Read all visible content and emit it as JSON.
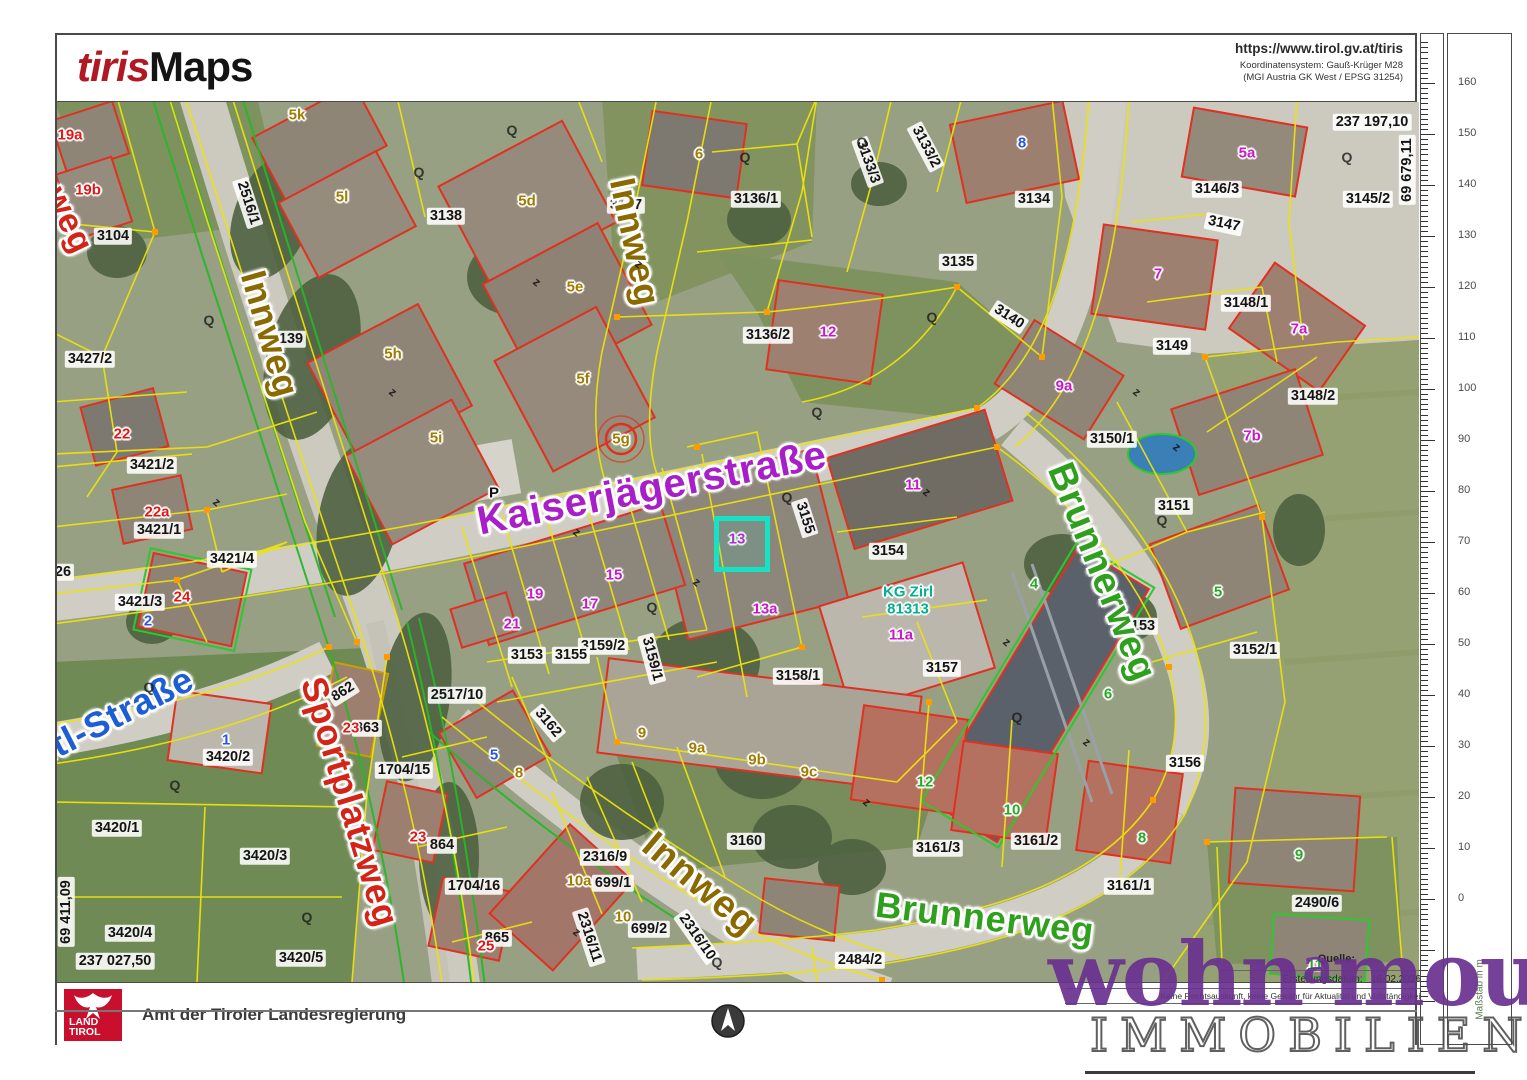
{
  "header": {
    "logo_part1": "tiris",
    "logo_part2": "Maps",
    "url": "https://www.tirol.gv.at/tiris",
    "coord_system_line1": "Koordinatensystem:  Gauß-Krüger M28",
    "coord_system_line2": "(MGI Austria GK West / EPSG 31254)"
  },
  "footer": {
    "agency": "Amt der Tiroler Landesregierung",
    "logo_line1": "LAND",
    "logo_line2": "TIROL",
    "source_label": "Quelle:",
    "creation_label": "Erstellungsdatum:",
    "creation_date": "16.02.2026",
    "disclaimer": "Keine Rechtsauskunft, keine Gewähr für Aktualität und Vollständigkeit."
  },
  "watermark": {
    "line1_pre": "wohn",
    "line1_sup": "a",
    "line1_post": "mour",
    "line2": "IMMOBILIEN"
  },
  "ruler": {
    "unit_label": "Maßstab in m",
    "tick_labels": [
      "160",
      "150",
      "140",
      "130",
      "120",
      "110",
      "100",
      "90",
      "80",
      "70",
      "60",
      "50",
      "40",
      "30",
      "20",
      "10",
      "0"
    ]
  },
  "colors": {
    "street_olive": "#8a6a00",
    "street_magenta": "#a81ec8",
    "street_green": "#2fa01e",
    "street_red": "#d42418",
    "street_blue": "#1e5ed4",
    "building_red": "#e01818",
    "building_magenta": "#c818c8",
    "building_olive": "#a07c00",
    "building_green": "#28a828",
    "building_blue": "#2858d8",
    "area_teal": "#00b090",
    "selection_cyan": "#18e2c4",
    "brand_red": "#b01823",
    "land_tirol_red": "#c8102e",
    "watermark_purple": "#6a3090"
  },
  "map": {
    "coord_labels": [
      {
        "t": "237 197,10",
        "x": 1315,
        "y": 20,
        "r": 0
      },
      {
        "t": "69 679,11",
        "x": 1350,
        "y": 68,
        "r": -90
      },
      {
        "t": "69 411,09",
        "x": 9,
        "y": 810,
        "r": -90
      },
      {
        "t": "237 027,50",
        "x": 58,
        "y": 859,
        "r": 0
      }
    ],
    "street_labels": [
      {
        "t": "weg",
        "x": 12,
        "y": 118,
        "r": 64,
        "c": "#d42418",
        "s": 34
      },
      {
        "t": "Innweg",
        "x": 213,
        "y": 232,
        "r": 74,
        "c": "#8a6a00",
        "s": 36
      },
      {
        "t": "Innweg",
        "x": 578,
        "y": 140,
        "r": 78,
        "c": "#8a6a00",
        "s": 36
      },
      {
        "t": "Kaiserjägerstraße",
        "x": 595,
        "y": 386,
        "r": -11,
        "c": "#a81ec8",
        "s": 40
      },
      {
        "t": "Brunnerweg",
        "x": 1045,
        "y": 470,
        "r": 68,
        "c": "#2fa01e",
        "s": 38
      },
      {
        "t": "ntl-Straße",
        "x": 55,
        "y": 615,
        "r": -27,
        "c": "#1e5ed4",
        "s": 36
      },
      {
        "t": "Sportplatzweg",
        "x": 293,
        "y": 700,
        "r": 73,
        "c": "#d42418",
        "s": 36
      },
      {
        "t": "Innweg",
        "x": 643,
        "y": 782,
        "r": 40,
        "c": "#8a6a00",
        "s": 38
      },
      {
        "t": "Brunnerweg",
        "x": 928,
        "y": 816,
        "r": 7,
        "c": "#2fa01e",
        "s": 36
      }
    ],
    "parcel_labels": [
      {
        "t": "3104",
        "x": 56,
        "y": 134
      },
      {
        "t": "3427/2",
        "x": 33,
        "y": 257
      },
      {
        "t": "2516/1",
        "x": 191,
        "y": 101,
        "r": 72
      },
      {
        "t": "3139",
        "x": 230,
        "y": 237
      },
      {
        "t": "3138",
        "x": 389,
        "y": 114
      },
      {
        "t": "3137",
        "x": 569,
        "y": 103
      },
      {
        "t": "3136/1",
        "x": 699,
        "y": 97
      },
      {
        "t": "3133/3",
        "x": 811,
        "y": 60,
        "r": 70
      },
      {
        "t": "3133/2",
        "x": 869,
        "y": 45,
        "r": 62
      },
      {
        "t": "3134",
        "x": 977,
        "y": 97
      },
      {
        "t": "3135",
        "x": 901,
        "y": 160
      },
      {
        "t": "3136/2",
        "x": 711,
        "y": 233
      },
      {
        "t": "3140",
        "x": 952,
        "y": 215,
        "r": 33
      },
      {
        "t": "3146/3",
        "x": 1160,
        "y": 87
      },
      {
        "t": "3145/2",
        "x": 1311,
        "y": 97
      },
      {
        "t": "3147",
        "x": 1167,
        "y": 122,
        "r": 12
      },
      {
        "t": "3148/1",
        "x": 1189,
        "y": 201
      },
      {
        "t": "3149",
        "x": 1115,
        "y": 244
      },
      {
        "t": "3148/2",
        "x": 1256,
        "y": 294
      },
      {
        "t": "3150/1",
        "x": 1055,
        "y": 337
      },
      {
        "t": "3151",
        "x": 1117,
        "y": 404
      },
      {
        "t": "3154",
        "x": 831,
        "y": 449
      },
      {
        "t": "3157",
        "x": 885,
        "y": 566
      },
      {
        "t": "3153",
        "x": 1082,
        "y": 524
      },
      {
        "t": "3155",
        "x": 748,
        "y": 416,
        "r": 72
      },
      {
        "t": "3159/2",
        "x": 546,
        "y": 544
      },
      {
        "t": "3153",
        "x": 470,
        "y": 553
      },
      {
        "t": "3155",
        "x": 514,
        "y": 553
      },
      {
        "t": "3159/1",
        "x": 595,
        "y": 557,
        "r": 75
      },
      {
        "t": "3158/1",
        "x": 741,
        "y": 574
      },
      {
        "t": "3152/1",
        "x": 1198,
        "y": 548
      },
      {
        "t": "3156",
        "x": 1128,
        "y": 661
      },
      {
        "t": "2517/10",
        "x": 400,
        "y": 593
      },
      {
        "t": "3162",
        "x": 491,
        "y": 621,
        "r": 50
      },
      {
        "t": "3160",
        "x": 689,
        "y": 739
      },
      {
        "t": "2316/9",
        "x": 548,
        "y": 755
      },
      {
        "t": "699/1",
        "x": 556,
        "y": 781
      },
      {
        "t": "699/2",
        "x": 592,
        "y": 827
      },
      {
        "t": "2316/11",
        "x": 532,
        "y": 835,
        "r": 72
      },
      {
        "t": "2316/10",
        "x": 640,
        "y": 835,
        "r": 55
      },
      {
        "t": "1704/15",
        "x": 347,
        "y": 668
      },
      {
        "t": "1704/16",
        "x": 417,
        "y": 784
      },
      {
        "t": "862",
        "x": 286,
        "y": 590,
        "r": -32
      },
      {
        "t": "863",
        "x": 310,
        "y": 626
      },
      {
        "t": "864",
        "x": 385,
        "y": 743
      },
      {
        "t": "865",
        "x": 440,
        "y": 836
      },
      {
        "t": "3420/2",
        "x": 171,
        "y": 655
      },
      {
        "t": "3420/1",
        "x": 60,
        "y": 726
      },
      {
        "t": "3420/3",
        "x": 208,
        "y": 754
      },
      {
        "t": "3420/4",
        "x": 73,
        "y": 831
      },
      {
        "t": "3420/5",
        "x": 244,
        "y": 856
      },
      {
        "t": "3421/2",
        "x": 95,
        "y": 363
      },
      {
        "t": "3421/1",
        "x": 102,
        "y": 428
      },
      {
        "t": "3421/4",
        "x": 175,
        "y": 457
      },
      {
        "t": "3421/3",
        "x": 83,
        "y": 500
      },
      {
        "t": "2484/2",
        "x": 803,
        "y": 858
      },
      {
        "t": "2490/6",
        "x": 1260,
        "y": 801
      },
      {
        "t": "3161/3",
        "x": 881,
        "y": 746
      },
      {
        "t": "3161/2",
        "x": 979,
        "y": 739
      },
      {
        "t": "3161/1",
        "x": 1072,
        "y": 784
      },
      {
        "t": "26",
        "x": 6,
        "y": 470
      }
    ],
    "building_labels": [
      {
        "t": "19a",
        "x": 13,
        "y": 33,
        "c": "#e01818"
      },
      {
        "t": "19b",
        "x": 31,
        "y": 88,
        "c": "#e01818"
      },
      {
        "t": "22",
        "x": 65,
        "y": 332,
        "c": "#e01818"
      },
      {
        "t": "22a",
        "x": 100,
        "y": 410,
        "c": "#e01818"
      },
      {
        "t": "24",
        "x": 125,
        "y": 495,
        "c": "#e01818"
      },
      {
        "t": "23",
        "x": 294,
        "y": 626,
        "c": "#e01818"
      },
      {
        "t": "23",
        "x": 361,
        "y": 735,
        "c": "#e01818"
      },
      {
        "t": "25",
        "x": 429,
        "y": 844,
        "c": "#e01818"
      },
      {
        "t": "5a",
        "x": 1190,
        "y": 51,
        "c": "#c818c8"
      },
      {
        "t": "7",
        "x": 1101,
        "y": 172,
        "c": "#c818c8"
      },
      {
        "t": "7a",
        "x": 1242,
        "y": 227,
        "c": "#c818c8"
      },
      {
        "t": "9a",
        "x": 1007,
        "y": 284,
        "c": "#c818c8"
      },
      {
        "t": "12",
        "x": 771,
        "y": 230,
        "c": "#c818c8"
      },
      {
        "t": "11",
        "x": 856,
        "y": 383,
        "c": "#c818c8"
      },
      {
        "t": "13",
        "x": 680,
        "y": 437,
        "c": "#c818c8"
      },
      {
        "t": "13a",
        "x": 708,
        "y": 507,
        "c": "#c818c8"
      },
      {
        "t": "15",
        "x": 557,
        "y": 473,
        "c": "#c818c8"
      },
      {
        "t": "19",
        "x": 478,
        "y": 492,
        "c": "#c818c8"
      },
      {
        "t": "17",
        "x": 533,
        "y": 502,
        "c": "#c818c8"
      },
      {
        "t": "21",
        "x": 455,
        "y": 522,
        "c": "#c818c8"
      },
      {
        "t": "11a",
        "x": 844,
        "y": 533,
        "c": "#c818c8"
      },
      {
        "t": "7b",
        "x": 1195,
        "y": 334,
        "c": "#c818c8"
      },
      {
        "t": "5k",
        "x": 240,
        "y": 13,
        "c": "#a07c00"
      },
      {
        "t": "5l",
        "x": 285,
        "y": 95,
        "c": "#a07c00"
      },
      {
        "t": "5d",
        "x": 470,
        "y": 99,
        "c": "#a07c00"
      },
      {
        "t": "5e",
        "x": 518,
        "y": 185,
        "c": "#a07c00"
      },
      {
        "t": "5h",
        "x": 336,
        "y": 252,
        "c": "#a07c00"
      },
      {
        "t": "5f",
        "x": 526,
        "y": 277,
        "c": "#a07c00"
      },
      {
        "t": "5i",
        "x": 379,
        "y": 336,
        "c": "#a07c00"
      },
      {
        "t": "5g",
        "x": 564,
        "y": 337,
        "c": "#a07c00"
      },
      {
        "t": "6",
        "x": 642,
        "y": 52,
        "c": "#a07c00"
      },
      {
        "t": "9",
        "x": 585,
        "y": 631,
        "c": "#a07c00"
      },
      {
        "t": "9a",
        "x": 640,
        "y": 646,
        "c": "#a07c00"
      },
      {
        "t": "9b",
        "x": 700,
        "y": 658,
        "c": "#a07c00"
      },
      {
        "t": "9c",
        "x": 752,
        "y": 670,
        "c": "#a07c00"
      },
      {
        "t": "8",
        "x": 462,
        "y": 671,
        "c": "#a07c00"
      },
      {
        "t": "10a",
        "x": 522,
        "y": 779,
        "c": "#a07c00"
      },
      {
        "t": "10",
        "x": 566,
        "y": 815,
        "c": "#a07c00"
      },
      {
        "t": "8",
        "x": 965,
        "y": 41,
        "c": "#2858d8"
      },
      {
        "t": "2",
        "x": 91,
        "y": 519,
        "c": "#2858d8"
      },
      {
        "t": "1",
        "x": 169,
        "y": 638,
        "c": "#2858d8"
      },
      {
        "t": "5",
        "x": 437,
        "y": 653,
        "c": "#2858d8"
      },
      {
        "t": "4",
        "x": 977,
        "y": 482,
        "c": "#28a828"
      },
      {
        "t": "6",
        "x": 1051,
        "y": 592,
        "c": "#28a828"
      },
      {
        "t": "5",
        "x": 1161,
        "y": 490,
        "c": "#28a828"
      },
      {
        "t": "12",
        "x": 868,
        "y": 680,
        "c": "#28a828"
      },
      {
        "t": "10",
        "x": 955,
        "y": 708,
        "c": "#28a828"
      },
      {
        "t": "8",
        "x": 1085,
        "y": 736,
        "c": "#28a828"
      },
      {
        "t": "9",
        "x": 1242,
        "y": 753,
        "c": "#28a828"
      },
      {
        "t": "11",
        "x": 1258,
        "y": 863,
        "c": "#28a828"
      },
      {
        "t": "KG Zirl",
        "x": 851,
        "y": 490,
        "c": "#00b090"
      },
      {
        "t": "81313",
        "x": 851,
        "y": 507,
        "c": "#00b090"
      },
      {
        "t": "P",
        "x": 437,
        "y": 391,
        "c": "#111111"
      }
    ],
    "selection": {
      "label": "13",
      "x": 680,
      "y": 437,
      "size": 46
    },
    "symbols": [
      {
        "g": "Q",
        "x": 362,
        "y": 70
      },
      {
        "g": "Q",
        "x": 152,
        "y": 218
      },
      {
        "g": "Q",
        "x": 455,
        "y": 28
      },
      {
        "g": "Q",
        "x": 688,
        "y": 55
      },
      {
        "g": "Q",
        "x": 805,
        "y": 40
      },
      {
        "g": "Q",
        "x": 875,
        "y": 215
      },
      {
        "g": "Q",
        "x": 760,
        "y": 310
      },
      {
        "g": "Q",
        "x": 1290,
        "y": 55
      },
      {
        "g": "Q",
        "x": 730,
        "y": 395
      },
      {
        "g": "Q",
        "x": 595,
        "y": 505
      },
      {
        "g": "Q",
        "x": 92,
        "y": 585
      },
      {
        "g": "Q",
        "x": 118,
        "y": 683
      },
      {
        "g": "Q",
        "x": 250,
        "y": 815
      },
      {
        "g": "Q",
        "x": 660,
        "y": 860
      },
      {
        "g": "Q",
        "x": 960,
        "y": 615
      },
      {
        "g": "Q",
        "x": 90,
        "y": 890
      },
      {
        "g": "Q",
        "x": 1105,
        "y": 418
      },
      {
        "g": "z",
        "x": 160,
        "y": 400
      },
      {
        "g": "z",
        "x": 520,
        "y": 430
      },
      {
        "g": "z",
        "x": 640,
        "y": 480
      },
      {
        "g": "z",
        "x": 870,
        "y": 390
      },
      {
        "g": "z",
        "x": 1080,
        "y": 290
      },
      {
        "g": "z",
        "x": 1030,
        "y": 640
      },
      {
        "g": "z",
        "x": 810,
        "y": 700
      },
      {
        "g": "z",
        "x": 520,
        "y": 830
      },
      {
        "g": "z",
        "x": 950,
        "y": 540
      },
      {
        "g": "z",
        "x": 1120,
        "y": 345
      },
      {
        "g": "z",
        "x": 480,
        "y": 180
      },
      {
        "g": "z",
        "x": 336,
        "y": 290
      },
      {
        "g": "z",
        "x": 582,
        "y": 162
      }
    ]
  }
}
